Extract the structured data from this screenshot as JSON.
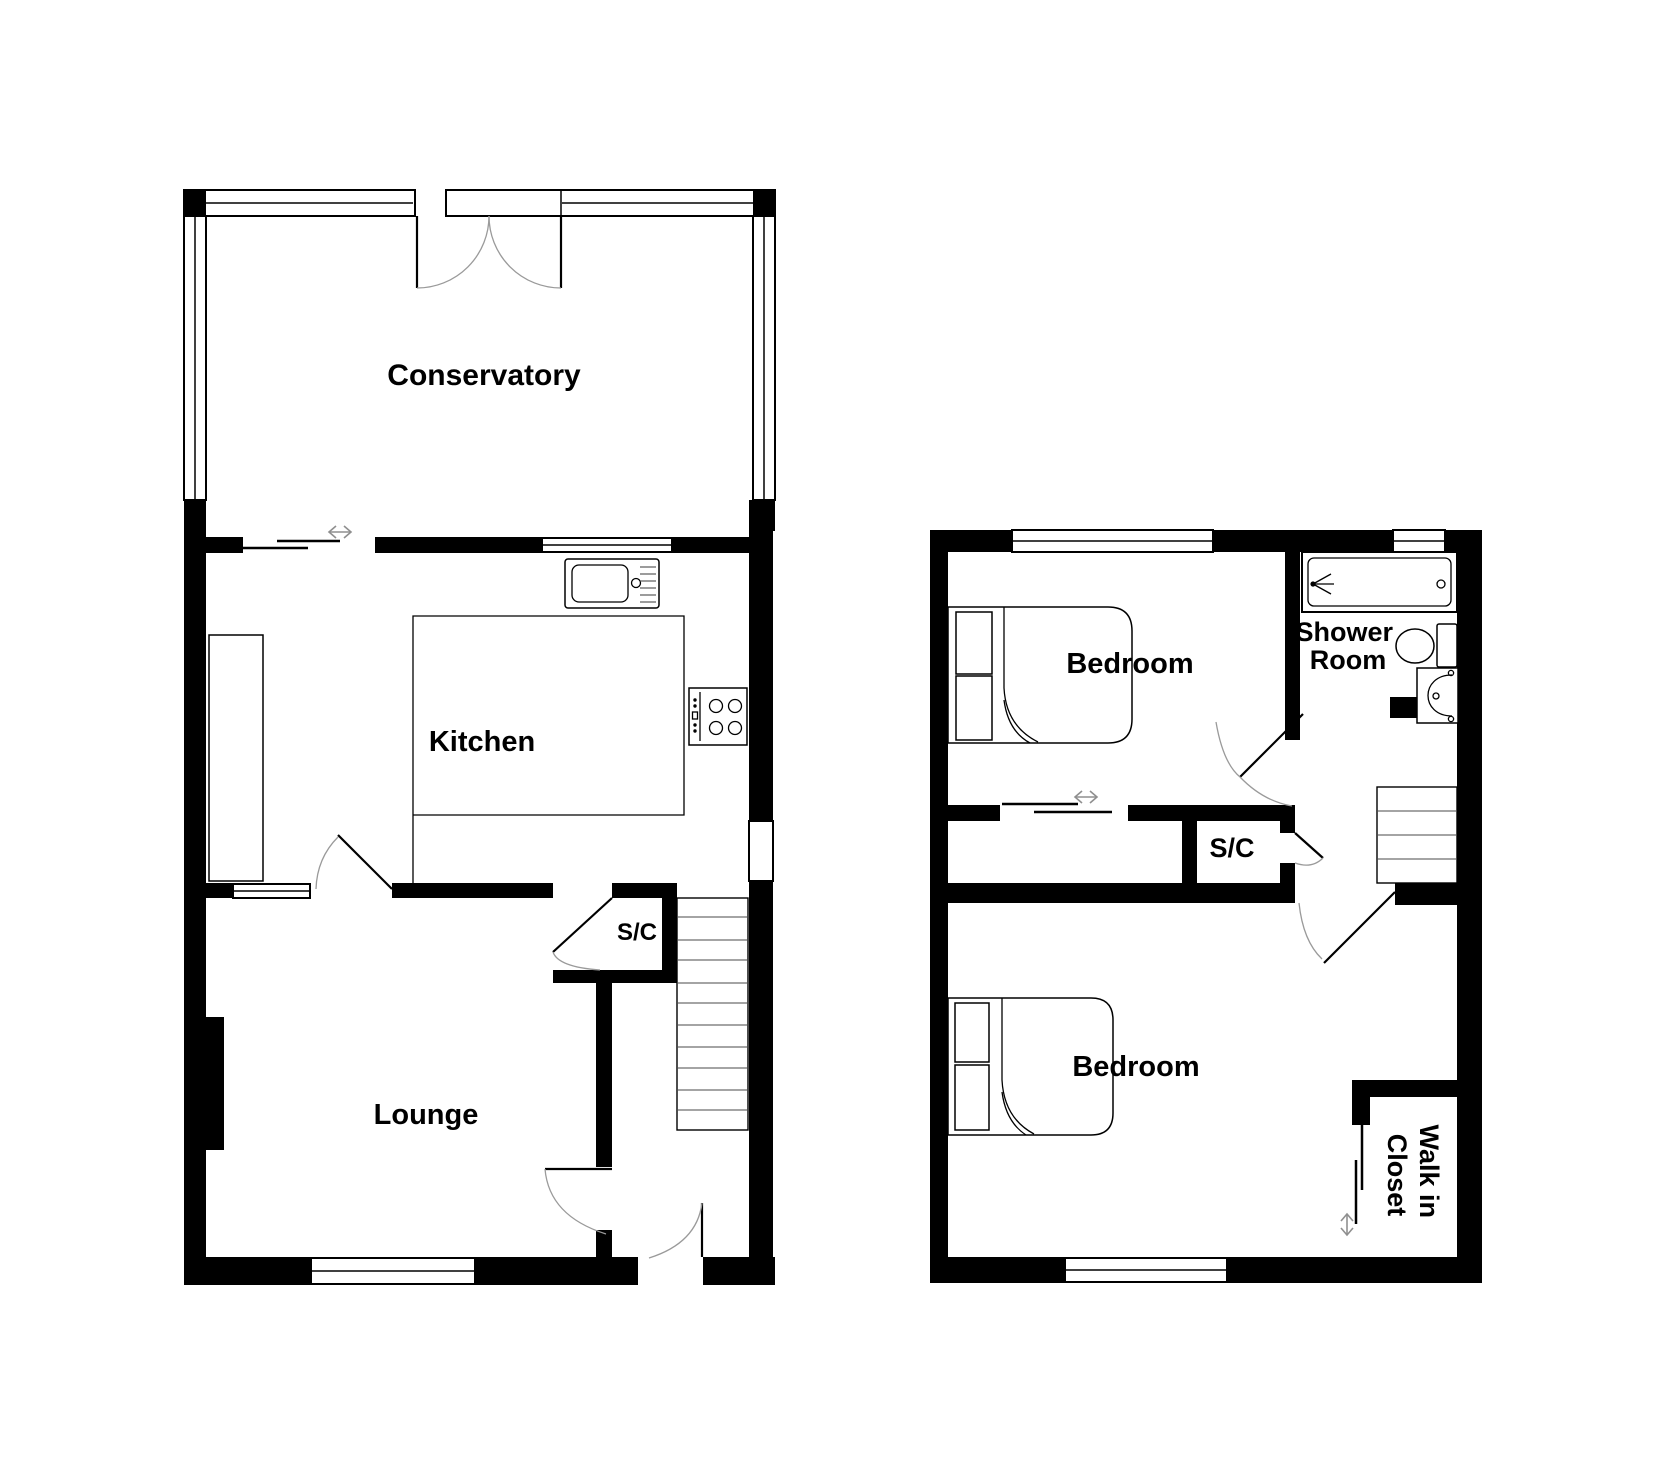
{
  "document": {
    "type": "floor-plan",
    "background_color": "#ffffff",
    "wall_color": "#000000",
    "door_arc_color": "#9a9a9a",
    "arrow_color": "#8f8f8f"
  },
  "floors": [
    {
      "id": "ground",
      "rooms": {
        "conservatory": "Conservatory",
        "kitchen": "Kitchen",
        "lounge": "Lounge",
        "cupboard": "S/C"
      }
    },
    {
      "id": "first",
      "rooms": {
        "bedroom_front": "Bedroom",
        "shower_line1": "Shower",
        "shower_line2": "Room",
        "cupboard": "S/C",
        "bedroom_back": "Bedroom",
        "closet_line1": "Walk in",
        "closet_line2": "Closet"
      }
    }
  ],
  "icons": {
    "sliding_door_horizontal": "double-arrow-horizontal",
    "sliding_door_vertical": "double-arrow-vertical",
    "kitchen_sink": "sink-with-drainer",
    "hob": "four-ring-hob",
    "bath": "bath-with-shower",
    "toilet": "toilet",
    "basin": "wash-basin",
    "bed": "double-bed",
    "stairs": "staircase"
  }
}
